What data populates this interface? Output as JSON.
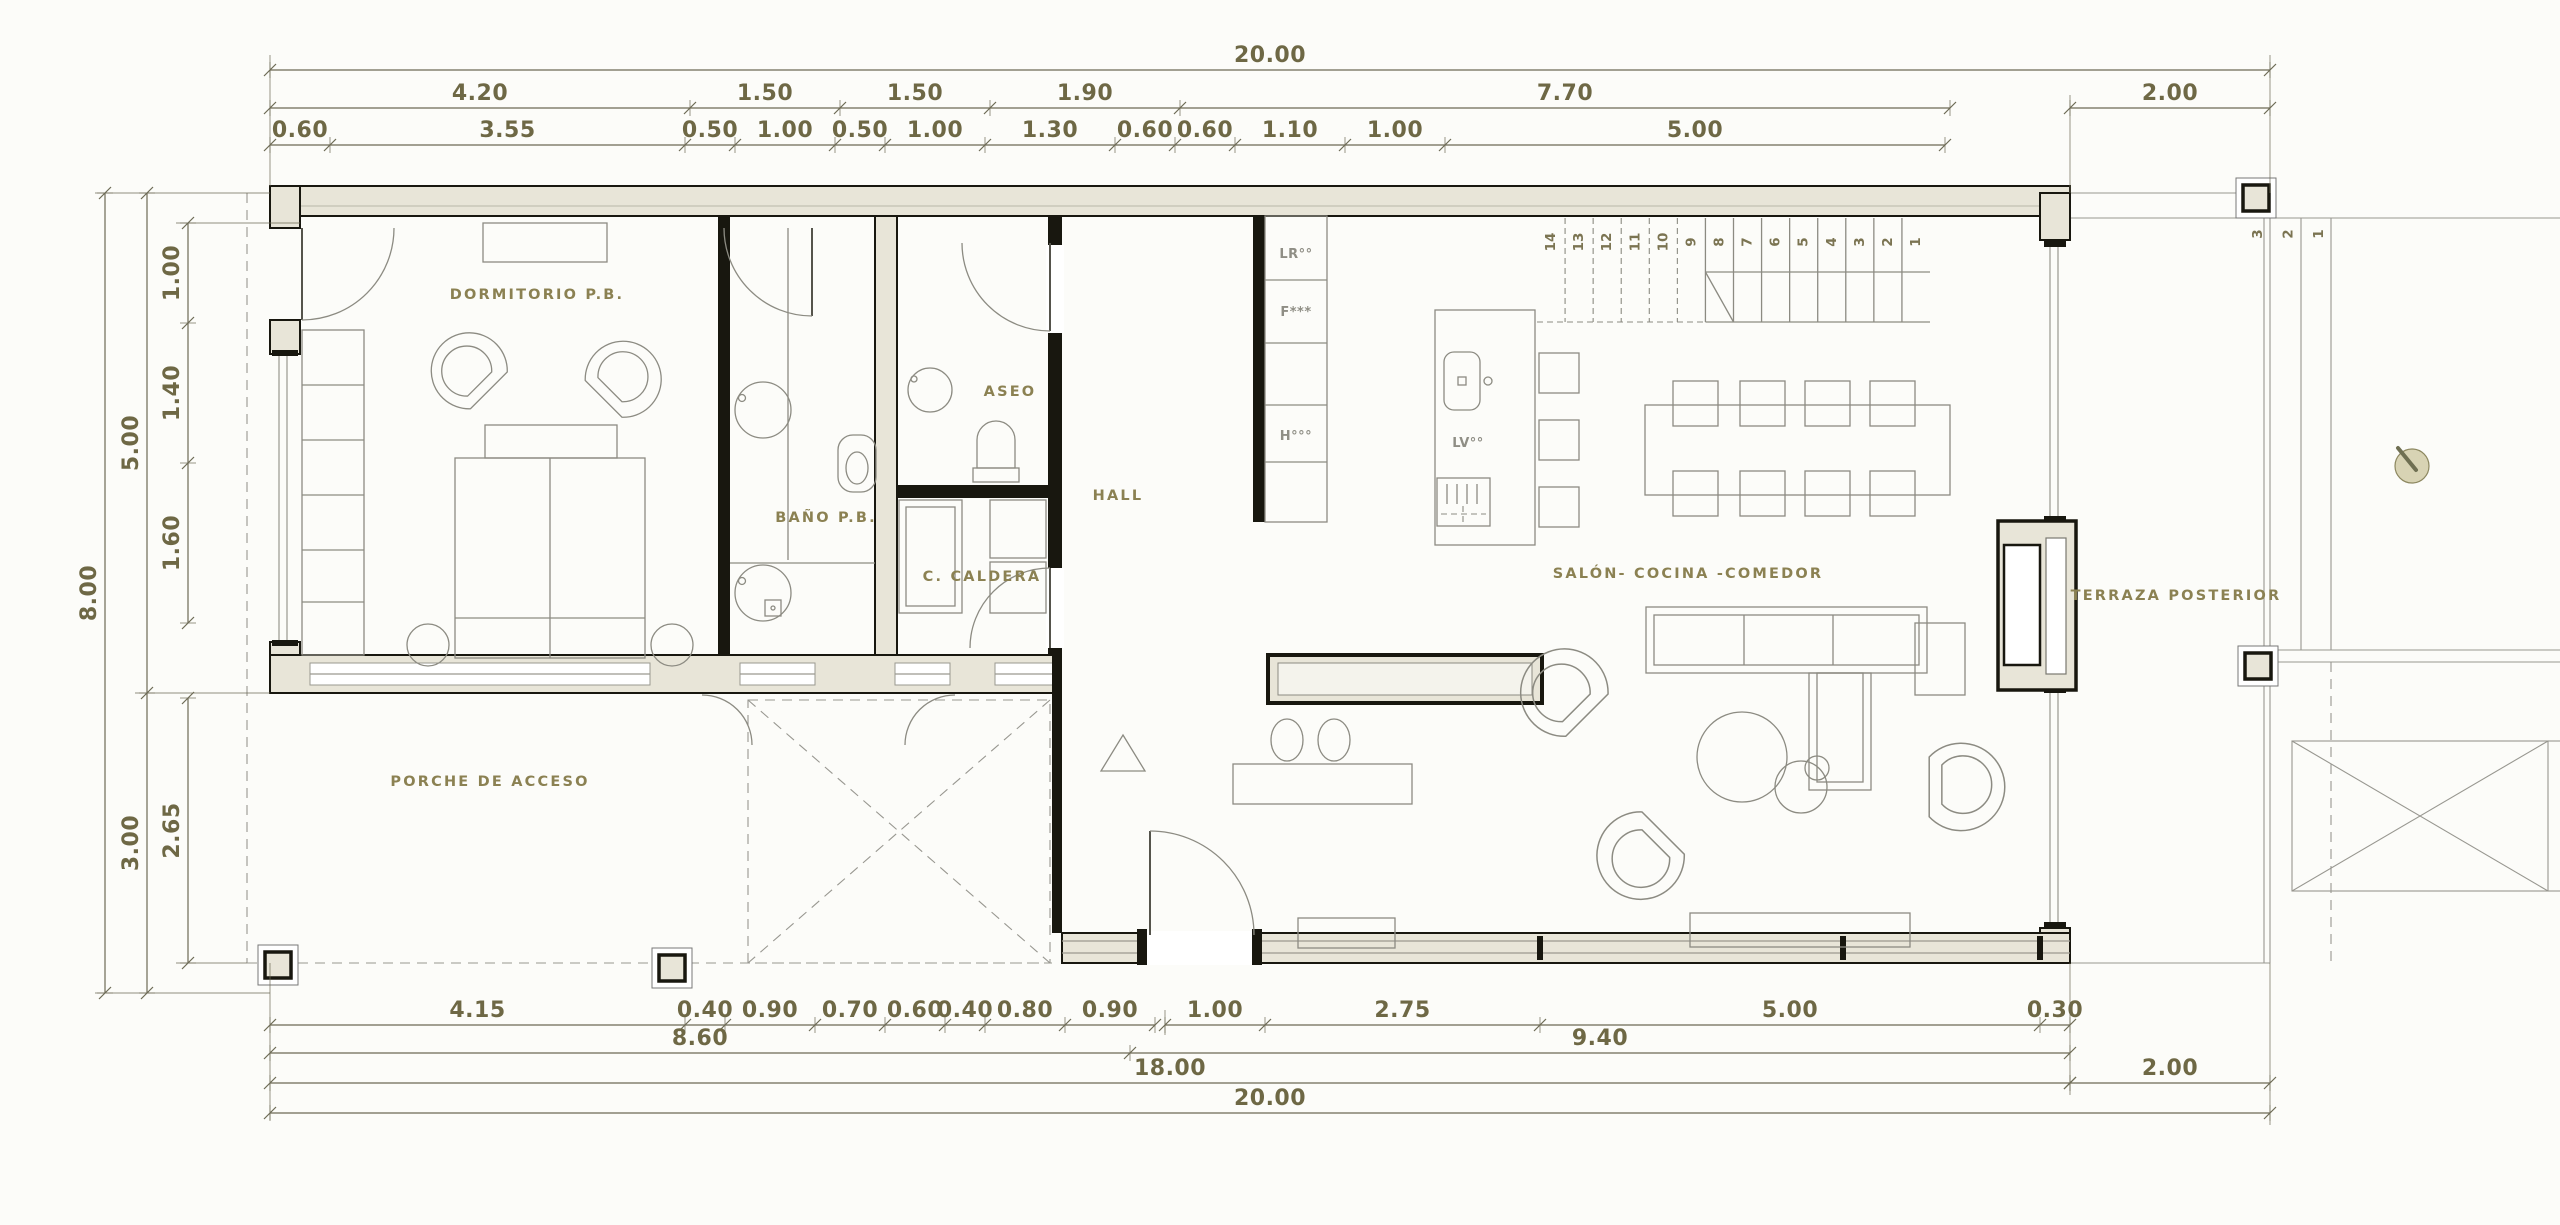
{
  "colors": {
    "paper": "#fcfcf9",
    "wall_fill": "#e8e5d8",
    "wall_line": "#18170f",
    "thin_line": "#989790",
    "furniture_line": "#8c8b82",
    "dim_line": "#6d6a55",
    "dim_text": "#6e6845",
    "label_text": "#8b8152",
    "tree_fill": "#d8d3b4",
    "tree_line": "#8c875f"
  },
  "rooms": {
    "dormitorio": "DORMITORIO P.B.",
    "bano": "BAÑO P.B.",
    "aseo": "ASEO",
    "caldera": "C. CALDERA",
    "hall": "HALL",
    "salon": "SALÓN- COCINA -COMEDOR",
    "terraza": "TERRAZA POSTERIOR",
    "porche": "PORCHE DE ACCESO"
  },
  "appliances": {
    "cabinet": [
      "LR°°",
      "F***",
      "H°°°"
    ],
    "dishwasher": "LV°°"
  },
  "stairs": {
    "interior": [
      "1",
      "2",
      "3",
      "4",
      "5",
      "6",
      "7",
      "8",
      "9",
      "10",
      "11",
      "12",
      "13",
      "14"
    ],
    "exterior": [
      "1",
      "2",
      "3"
    ]
  },
  "dimensions": {
    "top": [
      [
        [
          "20.00"
        ]
      ],
      [
        [
          "4.20",
          "1.50",
          "1.50",
          "1.90",
          "7.70"
        ],
        [
          "2.00"
        ]
      ],
      [
        [
          "0.60",
          "3.55",
          "0.50",
          "1.00",
          "0.50",
          "1.00",
          "1.30",
          "0.60",
          "0.60",
          "1.10",
          "1.00",
          "5.00"
        ]
      ]
    ],
    "bottom": [
      [
        [
          "4.15",
          "0.40",
          "0.90",
          "0.70",
          "0.60",
          "0.40",
          "0.80",
          "0.90"
        ],
        [
          "1.00",
          "2.75",
          "5.00",
          "0.30"
        ]
      ],
      [
        [
          "8.60",
          "9.40"
        ]
      ],
      [
        [
          "18.00"
        ],
        [
          "2.00"
        ]
      ],
      [
        [
          "20.00"
        ]
      ]
    ],
    "left": [
      [
        [
          "8.00"
        ]
      ],
      [
        [
          "5.00",
          "3.00"
        ]
      ],
      [
        [
          "1.00",
          "1.40",
          "1.60"
        ],
        [
          "2.65"
        ]
      ]
    ]
  }
}
